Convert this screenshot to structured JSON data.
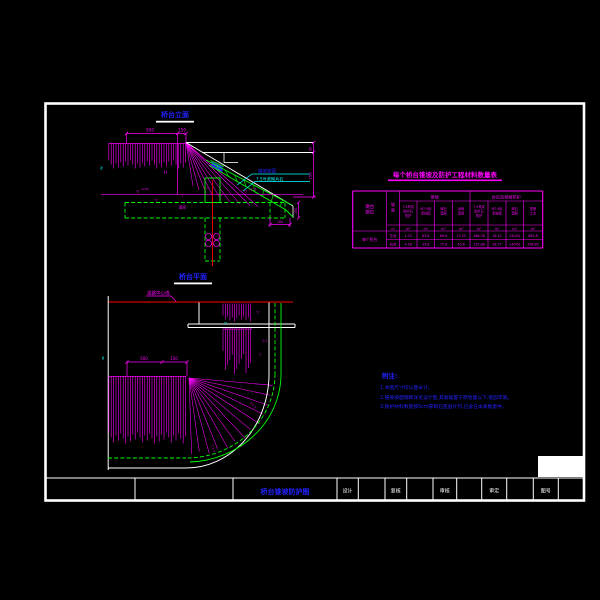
{
  "sheet": {
    "elevation_title": "桥台立面",
    "plan_title": "桥台平面"
  },
  "colors": {
    "background": "#000000",
    "frame": "#FFFFFF",
    "detail": "#FF00FF",
    "structure": "#00FF00",
    "leader": "#00FFFF",
    "annotation": "#0000FF",
    "centerline": "#FF0000"
  },
  "elevation": {
    "dims": {
      "top_left": "500",
      "top_right": "150",
      "height": "H",
      "right_upper": "90",
      "right_lower": "250",
      "toe_vertical": "150",
      "toe_horizontal": "100"
    },
    "labels": {
      "slope_surface": "锥坡坡面",
      "slope_material": "7.5号浆砌片石",
      "footing": "基底"
    },
    "levels": {
      "left_symbol": "▽",
      "left_value": "12.50",
      "mid_symbol": "▽",
      "right_symbol": "▽",
      "right_value": "10.25",
      "break_symbol": "≈"
    },
    "ratios": {
      "fan_a": "▽",
      "fan_b": "1:1"
    }
  },
  "plan": {
    "leader_label": "道路中心线",
    "dims": {
      "left": "500",
      "right": "150"
    },
    "labels": {
      "edge_symbol": "▽",
      "ratio_upper": "1:1",
      "ratio_mid": "1:1.5",
      "ratio_lower": "1:1.5",
      "corner_symbol": "▽",
      "break_symbol": "≈"
    }
  },
  "table": {
    "title": "每个桥台锥坡及防护工程材料数量表",
    "col_position": [
      "墩台",
      "部位"
    ],
    "col_slope": [
      "坡",
      "度"
    ],
    "group1": "锥坡",
    "group2": "台后及锥坡防护",
    "sub1": [
      [
        "7.5号浆",
        "砌片石",
        "防护"
      ],
      [
        "M7.5砂",
        "浆抹面"
      ],
      [
        "碎石",
        "垫层"
      ],
      [
        "砂砾",
        "垫层"
      ]
    ],
    "sub2": [
      [
        "7.5号浆",
        "砌片石",
        "防护"
      ],
      [
        "M7.5砂",
        "浆抹面"
      ],
      [
        "碎石",
        "垫层"
      ],
      [
        "挖基",
        "土方"
      ]
    ],
    "unit_slope": "m",
    "unit_vol": "m³",
    "row_label": "每个桥台",
    "rows": [
      {
        "side": "左台",
        "values": [
          "1.25",
          "65.8",
          "69.8",
          "15.35",
          "166.38",
          "18.12",
          "14(45)",
          "885.8"
        ]
      },
      {
        "side": "右台",
        "values": [
          "4.58",
          "35.8",
          "75.8",
          "45.8",
          "125.88",
          "28.77",
          "14(45)",
          "358.85"
        ]
      }
    ]
  },
  "notes": {
    "heading": "附注:",
    "lines": [
      "1.本图尺寸均以厘米计。",
      "2.锥坡坡面铺砌详见设计图,其基础置于原地面以下,嵌固牢靠。",
      "3.防护材料数量按5cm厚碎石垫层计列,已含在本表数量中。"
    ]
  },
  "title_block": {
    "drawing_title": "桥台锥坡防护图",
    "fields": [
      "设计",
      "复核",
      "审核",
      "审定",
      "图号"
    ]
  }
}
